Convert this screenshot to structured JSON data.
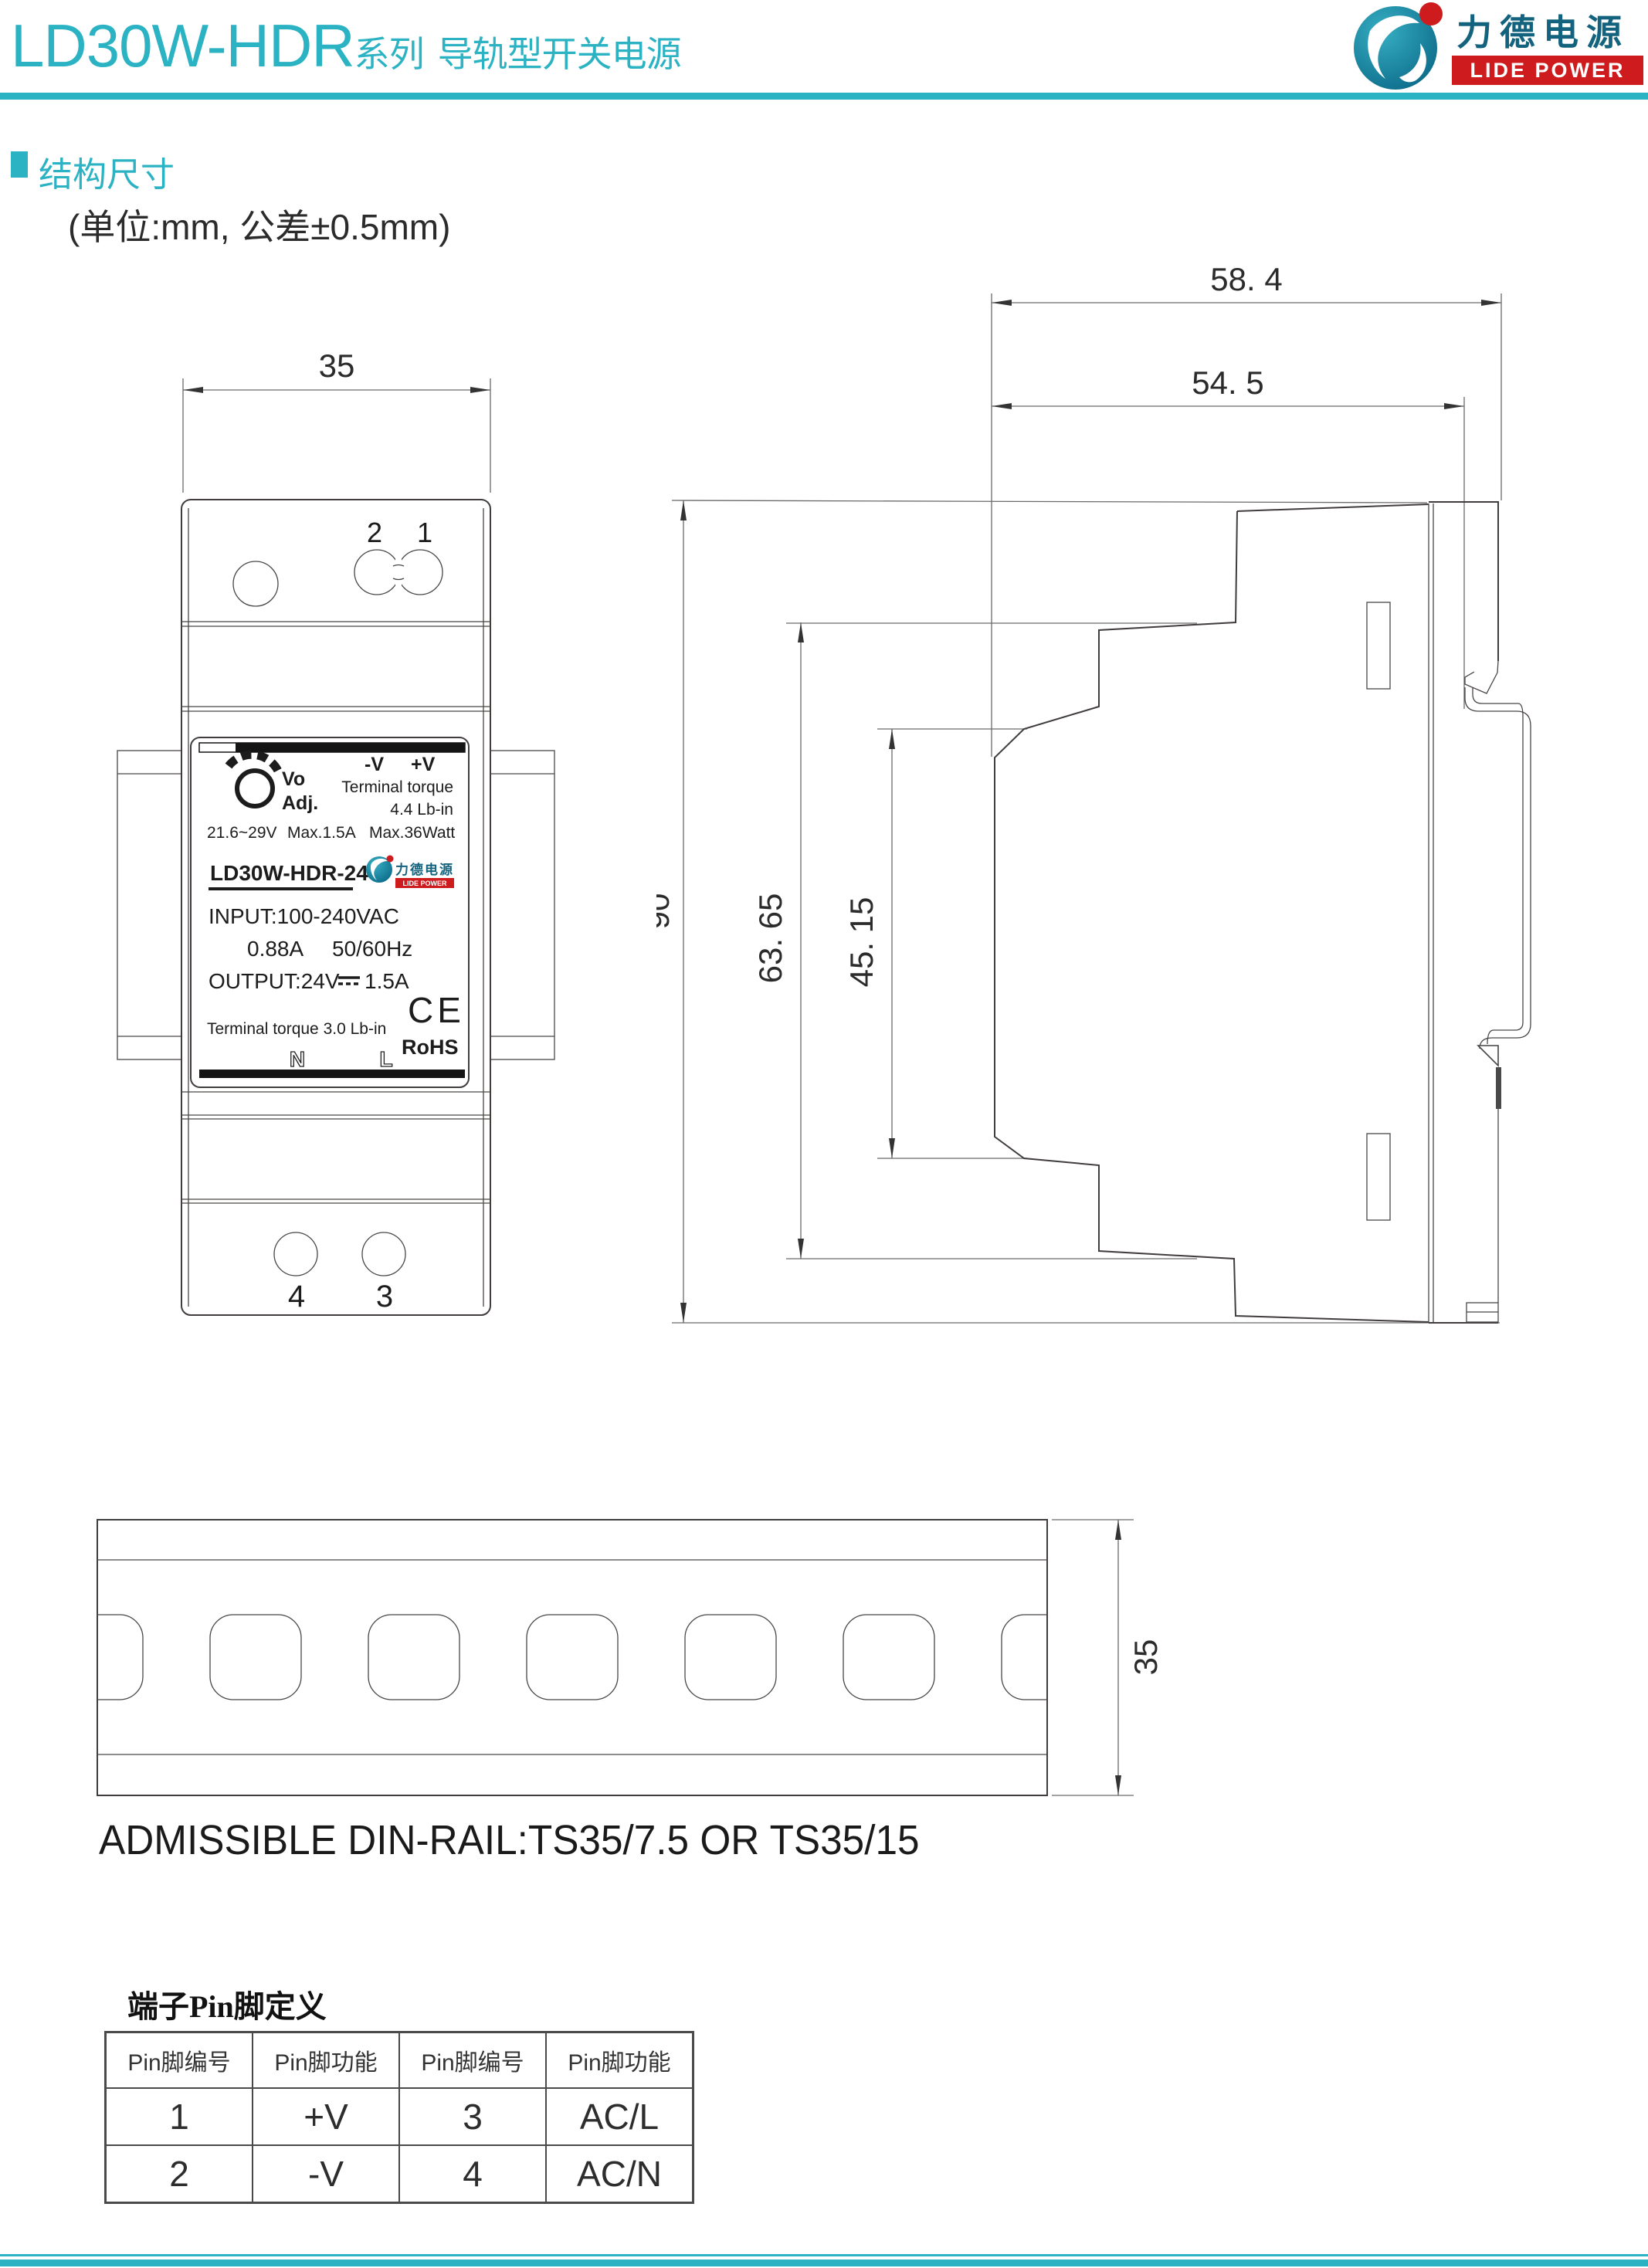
{
  "header": {
    "brand": "LD30W-HDR",
    "series": "系列",
    "product": "导轨型开关电源",
    "logo_cn": "力德电源",
    "logo_en": "LIDE POWER"
  },
  "section": {
    "title": "结构尺寸",
    "unit_note": "(单位:mm, 公差±0.5mm)"
  },
  "front_view": {
    "dim_width": "35",
    "pin_top_left": "2",
    "pin_top_right": "1",
    "pin_bottom_left": "4",
    "pin_bottom_right": "3",
    "label": {
      "vo": "Vo",
      "adj": "Adj.",
      "minus_v": "-V",
      "plus_v": "+V",
      "torque1": "Terminal torque",
      "torque2": "4.4 Lb-in",
      "range": "21.6~29V",
      "max_current": "Max.1.5A",
      "max_power": "Max.36Watt",
      "model": "LD30W-HDR-24",
      "logo_cn": "力德电源",
      "logo_en": "LIDE POWER",
      "input": "INPUT:100-240VAC",
      "input_current": "0.88A",
      "input_freq": "50/60Hz",
      "output": "OUTPUT:24V",
      "output_current": "1.5A",
      "ce": "CE",
      "torque3": "Terminal torque 3.0 Lb-in",
      "rohs": "RoHS",
      "n": "N",
      "l": "L"
    }
  },
  "side_view": {
    "dim_58": "58. 4",
    "dim_54": "54. 5",
    "dim_90": "90",
    "dim_63": "63. 65",
    "dim_45": "45. 15"
  },
  "din_rail": {
    "dim_35": "35",
    "caption": "ADMISSIBLE DIN-RAIL:TS35/7.5 OR TS35/15"
  },
  "pin_table": {
    "title": "端子Pin脚定义",
    "headers": [
      "Pin脚编号",
      "Pin脚功能",
      "Pin脚编号",
      "Pin脚功能"
    ],
    "rows": [
      [
        "1",
        "+V",
        "3",
        "AC/L"
      ],
      [
        "2",
        "-V",
        "4",
        "AC/N"
      ]
    ]
  },
  "colors": {
    "teal": "#2BB3C4",
    "red": "#CE1B1E",
    "dark": "#222222"
  }
}
